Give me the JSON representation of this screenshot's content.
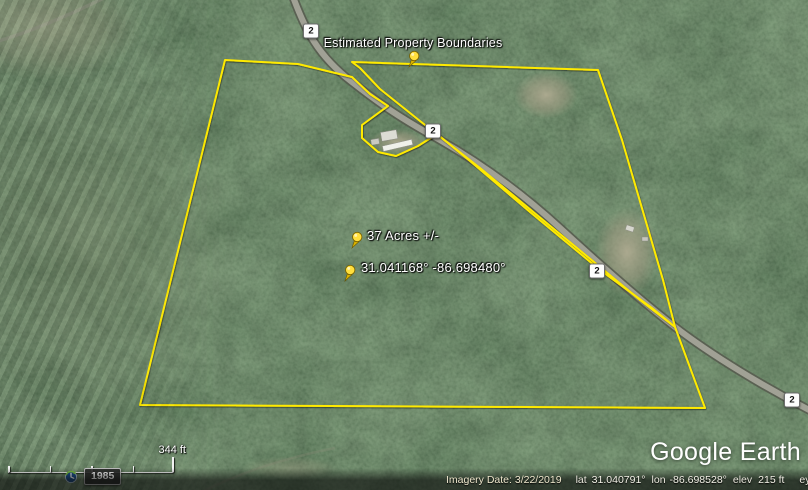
{
  "map_labels": {
    "boundary_label": "Estimated Property Boundaries",
    "acres_label": "37 Acres +/-",
    "coords_label": "31.041168° -86.698480°"
  },
  "shields": [
    "2",
    "2",
    "2",
    "2"
  ],
  "scale_bar": {
    "distance_label": "344 ft"
  },
  "time_slider": {
    "year": "1985"
  },
  "watermark": {
    "text": "Google Earth"
  },
  "status_bar": {
    "imagery_date": "Imagery Date: 3/22/2019",
    "lat_label": "lat",
    "lat_value": "31.040791°",
    "lon_label": "lon",
    "lon_value": "-86.698528°",
    "elev_label": "elev",
    "elev_value": "215 ft",
    "eye_alt_label": "eye alt",
    "eye_alt_value": "1666 ft"
  },
  "colors": {
    "boundary": "#ffea00",
    "pushpin": "#ffdf3d",
    "road": "#a8a89c"
  }
}
